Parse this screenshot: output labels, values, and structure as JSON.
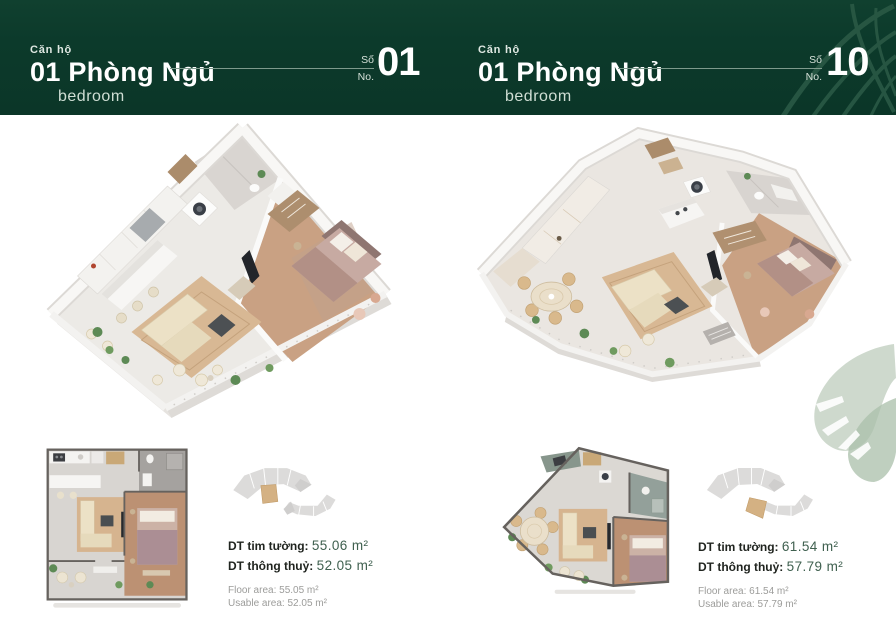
{
  "header": {
    "bg_color": "#0c3a2b",
    "line_color": "#7e9a8c",
    "left": {
      "eyebrow": "Căn hộ",
      "title": "01 Phòng Ngủ",
      "subtitle": "bedroom",
      "unit_label_vn": "Số",
      "unit_label_en": "No.",
      "unit_number": "01"
    },
    "right": {
      "eyebrow": "Căn hộ",
      "title": "01 Phòng Ngủ",
      "subtitle": "bedroom",
      "unit_label_vn": "Số",
      "unit_label_en": "No.",
      "unit_number": "10"
    }
  },
  "units": [
    {
      "number": "01",
      "area_labels": {
        "built": "DT tim tường:",
        "net": "DT thông thuỷ:"
      },
      "area_values": {
        "built": "55.06 m²",
        "net": "52.05 m²"
      },
      "area_en": {
        "floor": "Floor area: 55.05 m²",
        "usable": "Usable area: 52.05 m²"
      }
    },
    {
      "number": "10",
      "area_labels": {
        "built": "DT tim tường:",
        "net": "DT thông thuỷ:"
      },
      "area_values": {
        "built": "61.54 m²",
        "net": "57.79 m²"
      },
      "area_en": {
        "floor": "Floor area: 61.54 m²",
        "usable": "Usable area: 57.79 m²"
      }
    }
  ],
  "colors": {
    "header_green": "#0c3a2b",
    "value_green": "#3f604f",
    "keyplan_gray": "#dcdbda",
    "keyplan_highlight": "#d4b183",
    "wood_floor": "#c9a183",
    "leaf_watercolor": "#bccbba"
  }
}
